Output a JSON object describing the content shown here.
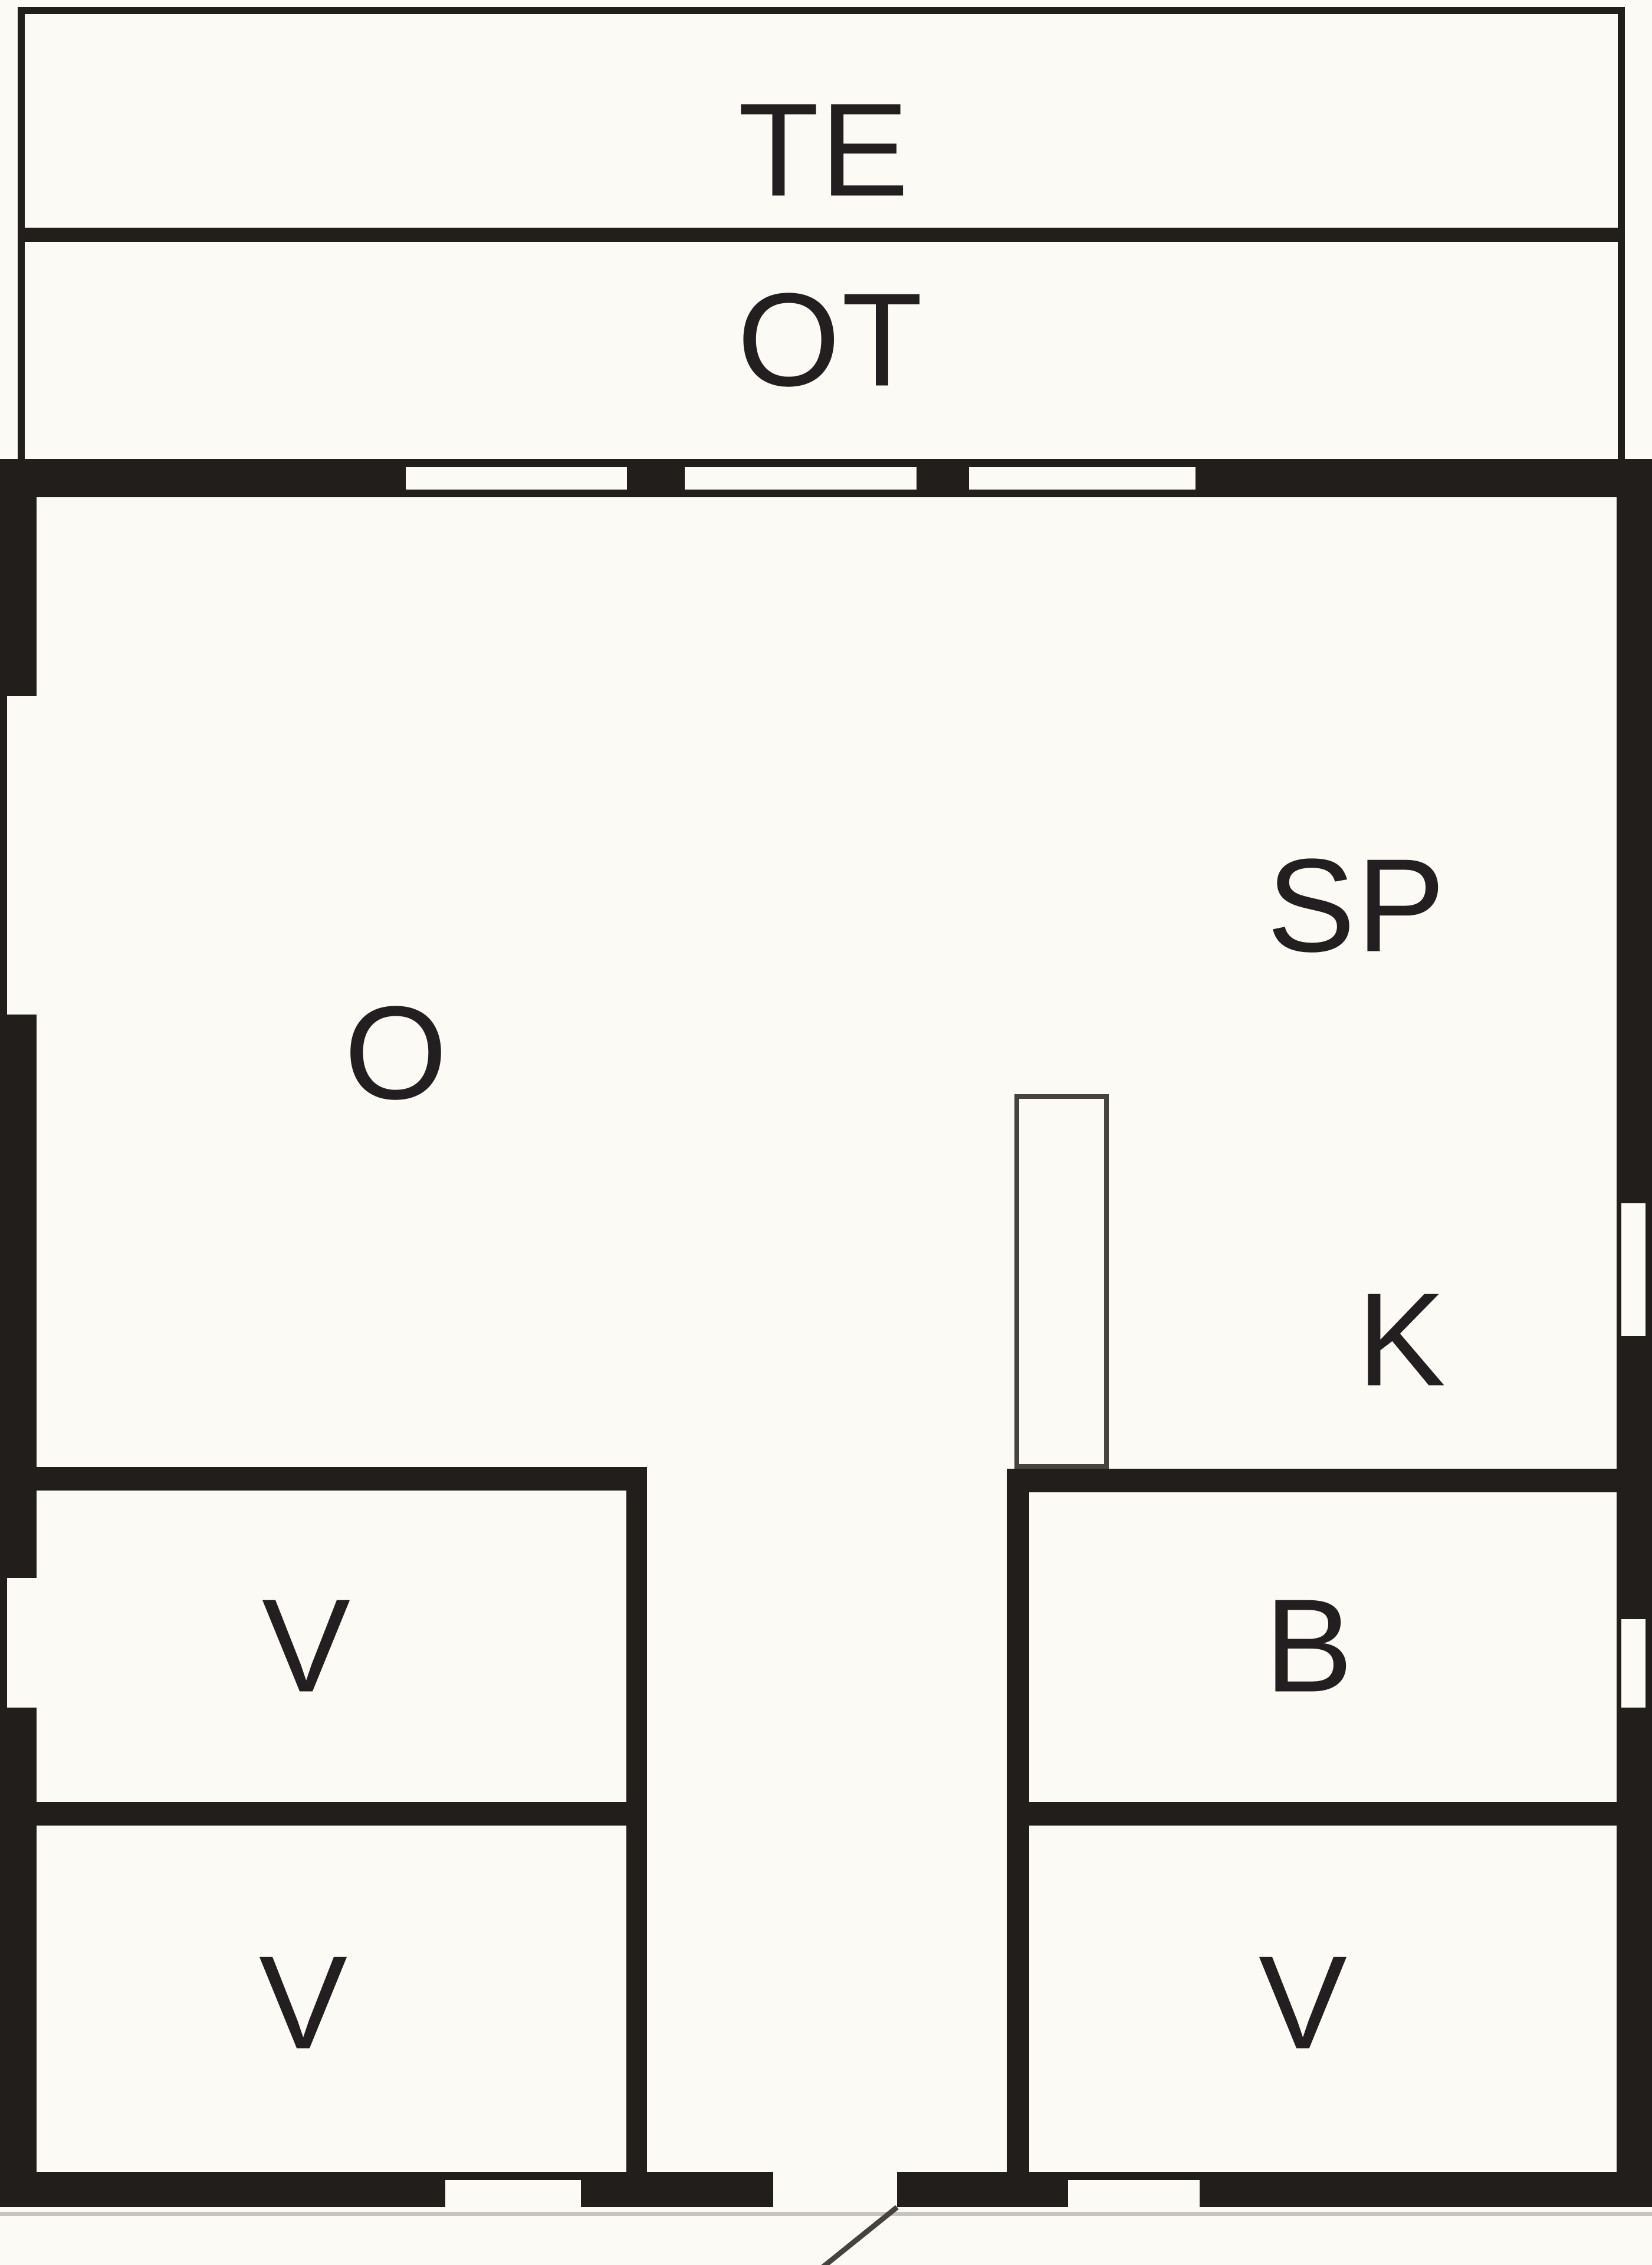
{
  "diagram": {
    "type": "floor-plan",
    "colors": {
      "background": "#fbfaf5",
      "wall": "#211e1c",
      "thin_line": "#454240",
      "label": "#231f20",
      "ground_line": "#c7c4be"
    },
    "labels": {
      "te": "TE",
      "ot": "OT",
      "o": "O",
      "sp": "SP",
      "k": "K",
      "v_upper_left": "V",
      "b": "B",
      "v_lower_left": "V",
      "v_lower_right": "V"
    },
    "features": {
      "top_wall_windows": 3,
      "left_wall_windows": 2,
      "right_wall_windows": 2,
      "bottom_wall_windows": 2,
      "door_openings": 1,
      "chimney": true
    }
  }
}
